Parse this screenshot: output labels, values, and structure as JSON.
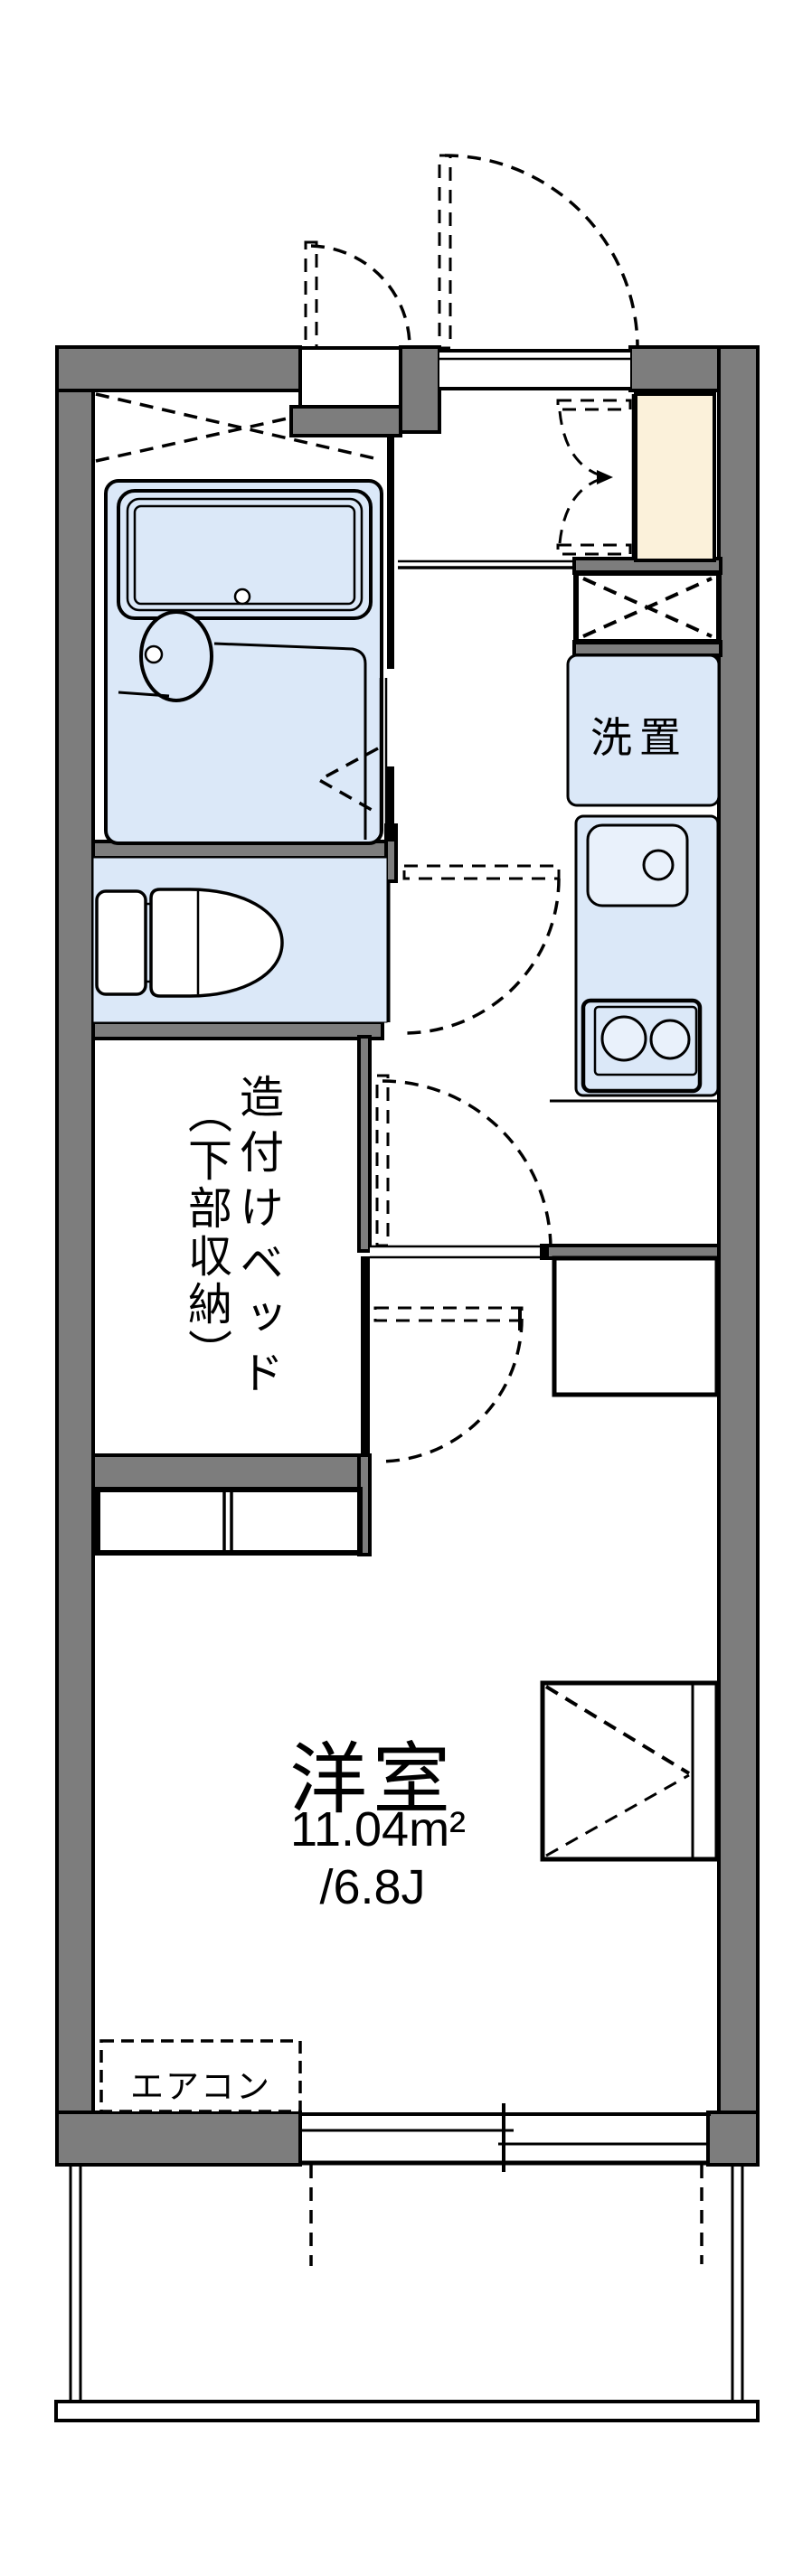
{
  "colors": {
    "wall_fill": "#7d7d7d",
    "line": "#000000",
    "fixture_fill": "#dbe8f8",
    "fixture_light": "#e9f1fb",
    "cabinet_fill": "#fbf1da",
    "text": "#000000",
    "bg": "#ffffff"
  },
  "labels": {
    "washer_place": "洗置",
    "bed_column_right": "造付けベッド",
    "bed_column_left": "（下部収納）",
    "main_room": "洋室",
    "main_room_area_sqm": "11.04m²",
    "main_room_area_tatami": "/6.8J",
    "aircon": "エアコン"
  }
}
